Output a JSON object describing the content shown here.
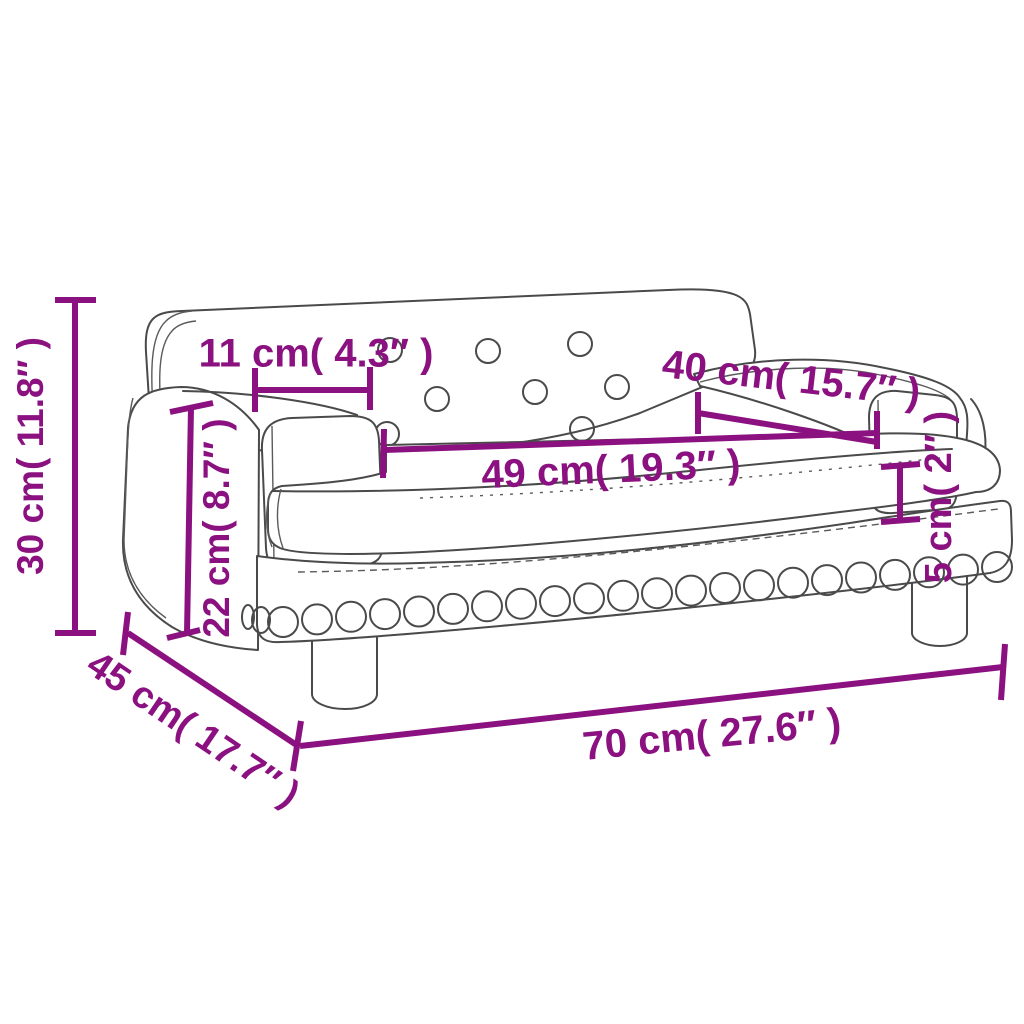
{
  "diagram": {
    "type": "product-dimension-diagram",
    "subject": "kids sofa with button-tufted backrest, stud trim and round legs",
    "colors": {
      "accent": "#8B1080",
      "line": "#4a4a4a",
      "background": "#ffffff"
    },
    "dimensions": [
      {
        "name": "overall-height",
        "value_cm": 30,
        "value_in": "11.8",
        "label": "30 cm( 11.8″ )"
      },
      {
        "name": "armrest-top-width",
        "value_cm": 11,
        "value_in": "4.3",
        "label": "11 cm( 4.3″ )"
      },
      {
        "name": "backrest-to-armrest-length",
        "value_cm": 40,
        "value_in": "15.7",
        "label": "40 cm( 15.7″ )"
      },
      {
        "name": "seat-length",
        "value_cm": 49,
        "value_in": "19.3",
        "label": "49 cm( 19.3″ )"
      },
      {
        "name": "seat-height",
        "value_cm": 22,
        "value_in": "8.7",
        "label": "22 cm( 8.7″ )"
      },
      {
        "name": "cushion-thickness",
        "value_cm": 5,
        "value_in": "2",
        "label": "5 cm( 2″ )"
      },
      {
        "name": "overall-depth",
        "value_cm": 45,
        "value_in": "17.7",
        "label": "45 cm( 17.7″ )"
      },
      {
        "name": "overall-width",
        "value_cm": 70,
        "value_in": "27.6",
        "label": "70 cm( 27.6″ )"
      }
    ]
  }
}
